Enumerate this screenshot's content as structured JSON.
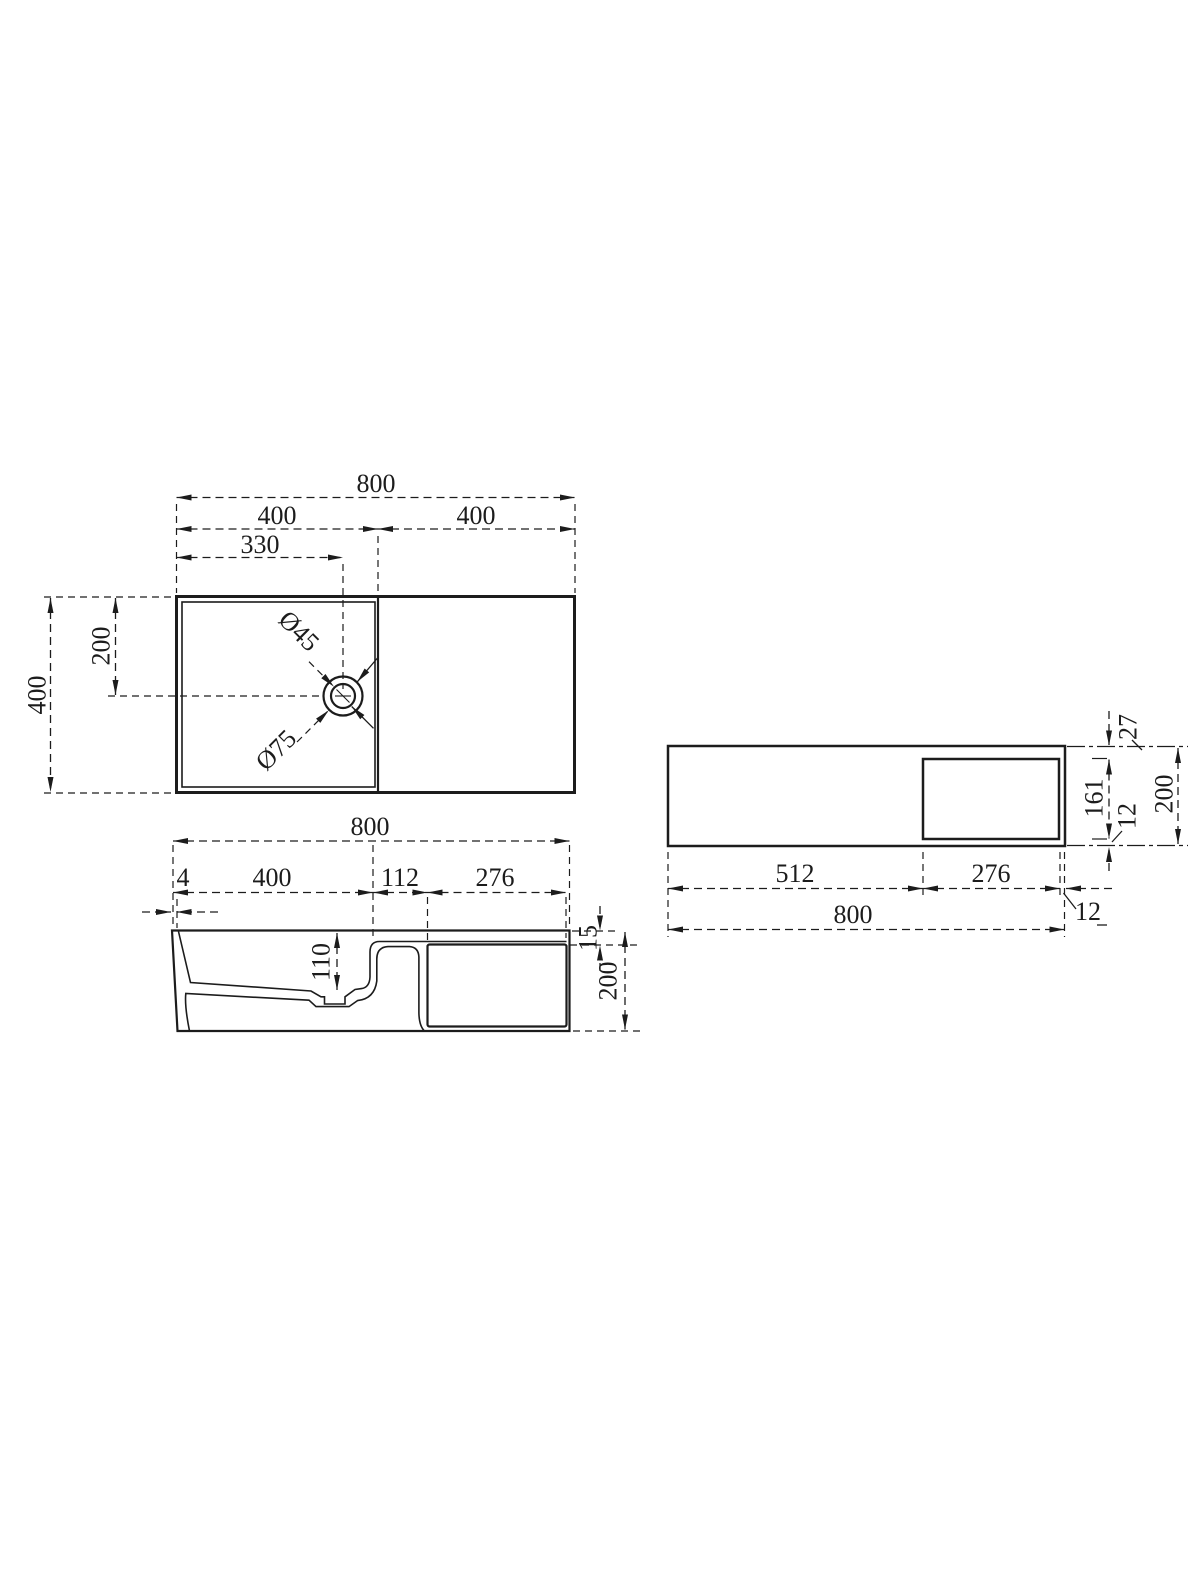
{
  "page": {
    "background": "#ffffff",
    "line_color": "#1c1c1c"
  },
  "views": {
    "top": {
      "dims": {
        "overall_width": "800",
        "left_section": "400",
        "right_section": "400",
        "drain_from_left": "330",
        "overall_depth": "400",
        "drain_from_back": "200",
        "drain_hole_diameter": "Ø45",
        "drain_flange_diameter": "Ø75"
      }
    },
    "front": {
      "dims": {
        "overall_width": "800",
        "wall_lip": "4",
        "bowl_width": "400",
        "step_width": "112",
        "recess_width": "276",
        "bowl_depth": "110",
        "ledge_drop": "15",
        "overall_height": "200"
      }
    },
    "side": {
      "dims": {
        "solid_width": "512",
        "recess_width": "276",
        "overall_width": "800",
        "recess_top_offset": "27",
        "recess_height": "161",
        "recess_bottom_offset": "12",
        "recess_edge_gap": "12",
        "overall_height": "200"
      }
    }
  }
}
